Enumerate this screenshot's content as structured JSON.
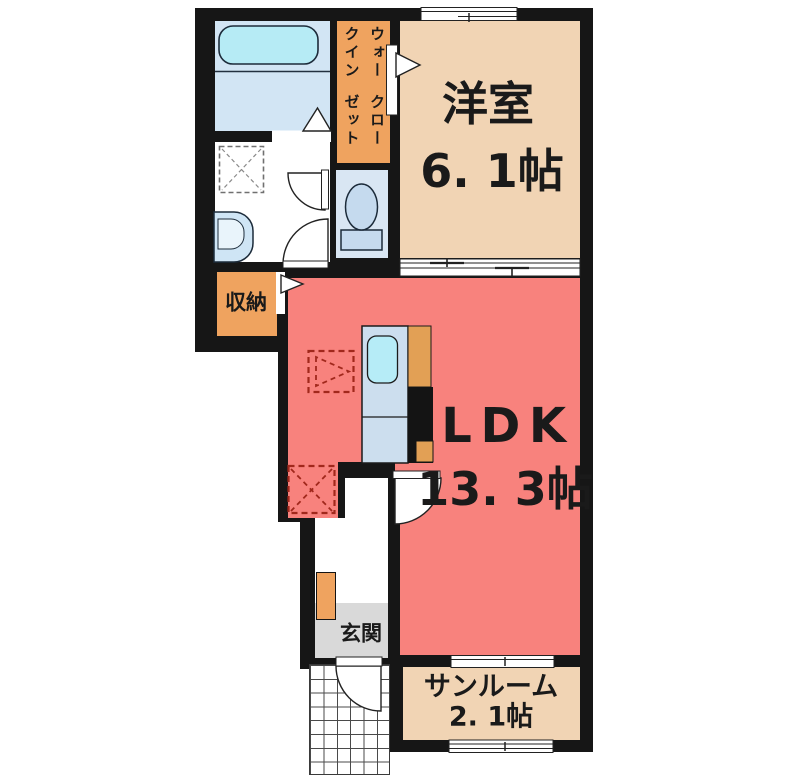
{
  "floorplan": {
    "rooms": {
      "western": {
        "name": "洋室",
        "area": "6. 1帖"
      },
      "ldk": {
        "name": "LDK",
        "area": "13. 3帖"
      },
      "sunroom": {
        "name": "サンルーム",
        "area": "2. 1帖"
      },
      "entrance": {
        "name": "玄関"
      },
      "storage": {
        "name": "収納"
      },
      "walk_in_closet": {
        "line1": "ウォークイン",
        "line2": "クローゼット"
      }
    },
    "colors": {
      "wall": "#161616",
      "ldk_floor": "#f8827d",
      "room_beige": "#f1d4b4",
      "closet_orange": "#efa35f",
      "bath_blue": "#d2e5f4",
      "toilet_blue": "#d9e6f3",
      "tub_cyan": "#b6ebf5",
      "counter_blue": "#ccdeee",
      "entrance_gray": "#d9d9d9",
      "dashed_red": "#a1281c",
      "text_black": "#1a1a1a"
    }
  }
}
